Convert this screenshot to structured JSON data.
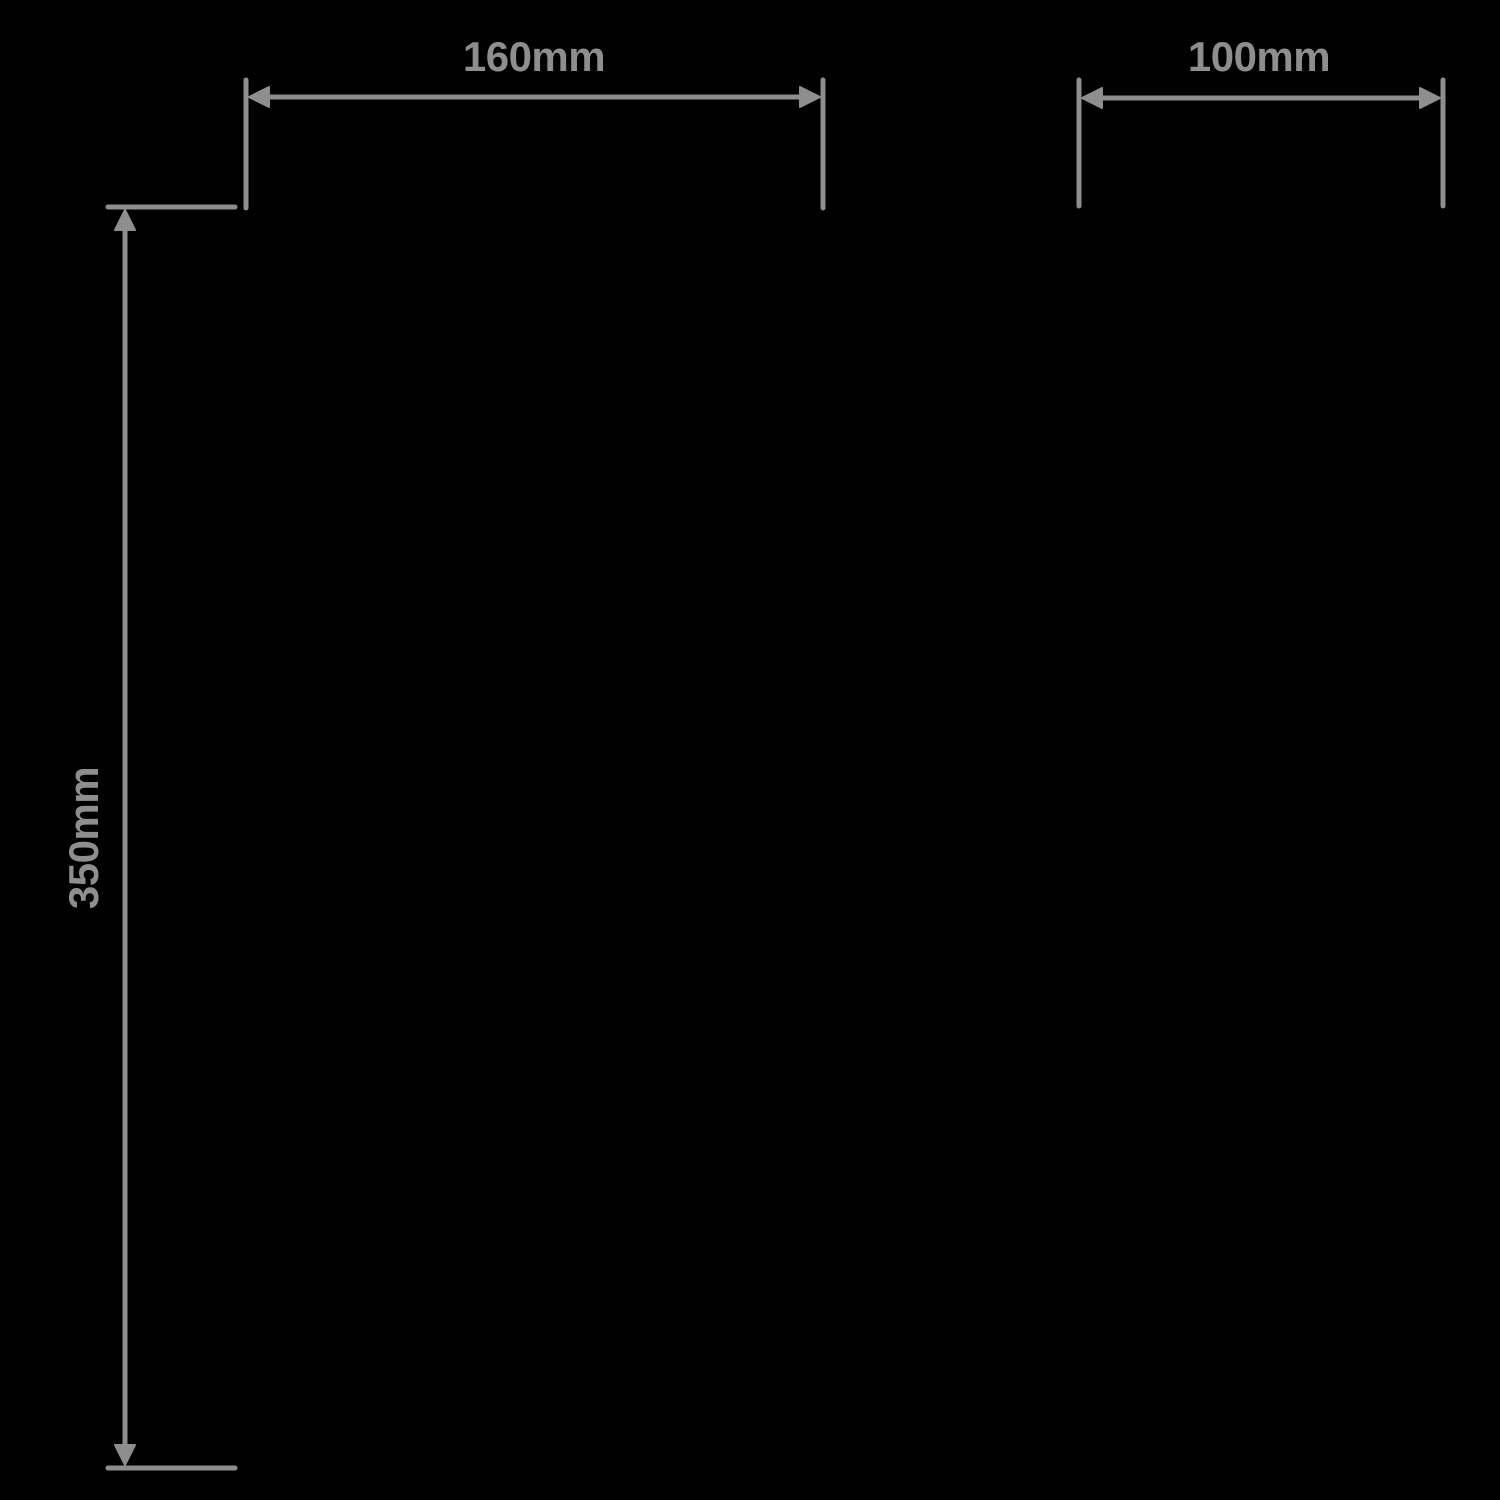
{
  "style": {
    "background": "#000000",
    "annotation_color": "#8e8e8e"
  },
  "diagram": {
    "type": "product-dimension-drawing",
    "dimensions": {
      "width": {
        "label": "160mm",
        "orientation": "horizontal",
        "position": "top-left"
      },
      "depth": {
        "label": "100mm",
        "orientation": "horizontal",
        "position": "top-right"
      },
      "height": {
        "label": "350mm",
        "orientation": "vertical",
        "position": "left"
      }
    }
  }
}
